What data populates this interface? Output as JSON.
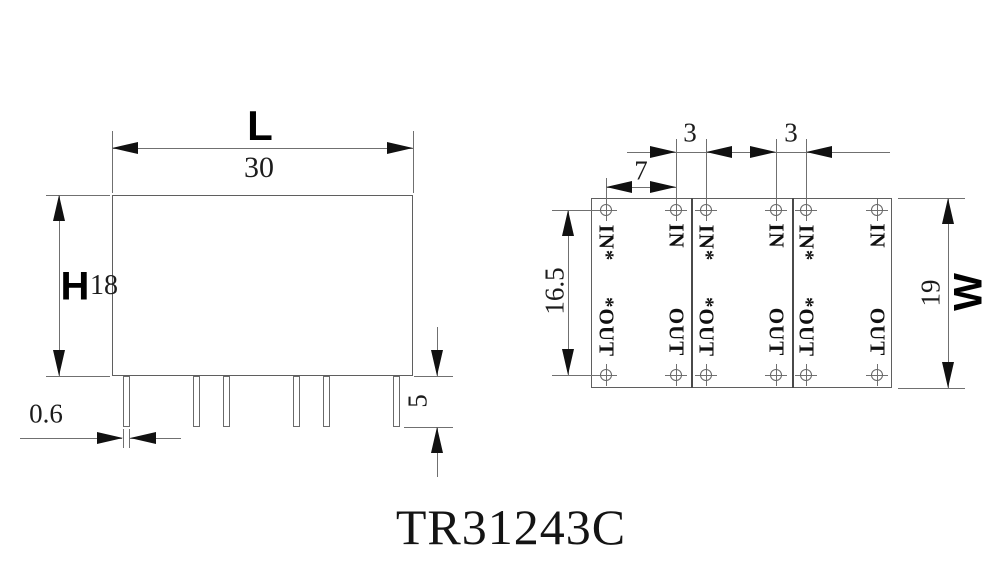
{
  "title": "TR31243C",
  "front_view": {
    "length_label": "L",
    "length_value": "30",
    "height_label": "H",
    "height_value": "18",
    "pin_width_value": "0.6",
    "pin_length_value": "5"
  },
  "top_view": {
    "pin_gap_1_value": "3",
    "pin_gap_2_value": "3",
    "pin_pitch_value": "7",
    "row_spacing_value": "16.5",
    "width_label": "W",
    "width_value": "19",
    "columns": [
      {
        "top": "IN*",
        "bottom": "*OUT"
      },
      {
        "top": "IN",
        "bottom": "OUT"
      },
      {
        "top": "IN*",
        "bottom": "*OUT"
      },
      {
        "top": "IN",
        "bottom": "OUT"
      },
      {
        "top": "IN*",
        "bottom": "*OUT"
      },
      {
        "top": "IN",
        "bottom": "OUT"
      }
    ]
  }
}
